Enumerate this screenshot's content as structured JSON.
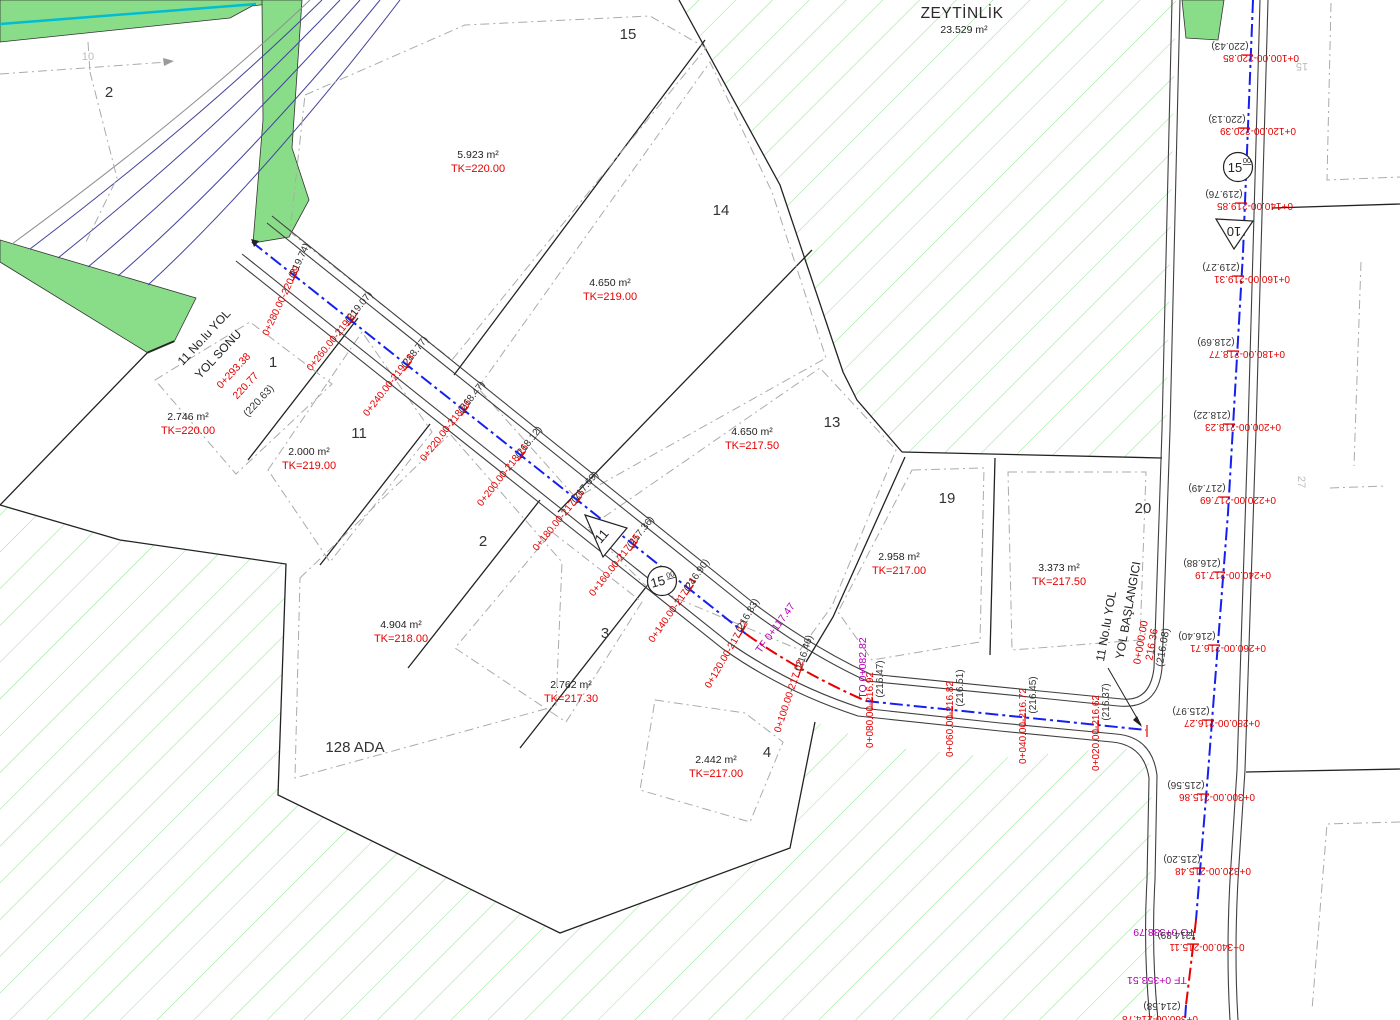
{
  "zeytinlik": {
    "name": "ZEYTİNLİK",
    "area": "23.529 m²"
  },
  "block_label": "128 ADA",
  "road_end": {
    "line1": "11 No.lu YOL",
    "line2": "YOL SONU",
    "km": "0+293.38",
    "elev": "220.77",
    "ground": "(220.63)"
  },
  "road_start": {
    "line1": "11 No.lu YOL",
    "line2": "YOL BAŞLANGICI",
    "km": "0+000.00",
    "elev": "216.36",
    "ground": "(216.08)"
  },
  "symbols": {
    "road11_sign": "11",
    "road10_sign": "10",
    "width11": "15",
    "width11_sup": "00",
    "width10": "15",
    "width10_sup": "00"
  },
  "faint_labels": {
    "p10": "10",
    "p15": "15",
    "p27": "27"
  },
  "curve_points": {
    "tf1": "TF 0+117.47",
    "to1": "TO 0+082.82",
    "to2": "TO 0+338.79",
    "tf2": "TF 0+353.51",
    "cut": "0+360.00-214.78",
    "cut_ground": "(214.58)"
  },
  "parcels": [
    {
      "no": "2",
      "area": "",
      "tk": "",
      "npos": [
        109,
        97
      ],
      "apos": null
    },
    {
      "no": "15",
      "area": "5.923 m²",
      "tk": "TK=220.00",
      "npos": [
        628,
        39
      ],
      "apos": [
        478,
        158
      ]
    },
    {
      "no": "14",
      "area": "4.650 m²",
      "tk": "TK=219.00",
      "npos": [
        721,
        215
      ],
      "apos": [
        610,
        286
      ]
    },
    {
      "no": "13",
      "area": "4.650 m²",
      "tk": "TK=217.50",
      "npos": [
        832,
        427
      ],
      "apos": [
        752,
        435
      ]
    },
    {
      "no": "19",
      "area": "2.958 m²",
      "tk": "TK=217.00",
      "npos": [
        947,
        503
      ],
      "apos": [
        899,
        560
      ]
    },
    {
      "no": "20",
      "area": "3.373 m²",
      "tk": "TK=217.50",
      "npos": [
        1143,
        513
      ],
      "apos": [
        1059,
        571
      ]
    },
    {
      "no": "1",
      "area": "2.746 m²",
      "tk": "TK=220.00",
      "npos": [
        273,
        367
      ],
      "apos": [
        188,
        420
      ]
    },
    {
      "no": "11",
      "area": "2.000 m²",
      "tk": "TK=219.00",
      "npos": [
        359,
        438
      ],
      "apos": [
        309,
        455
      ]
    },
    {
      "no": "2",
      "area": "4.904 m²",
      "tk": "TK=218.00",
      "npos": [
        483,
        546
      ],
      "apos": [
        401,
        628
      ]
    },
    {
      "no": "3",
      "area": "2.762 m²",
      "tk": "TK=217.30",
      "npos": [
        605,
        638
      ],
      "apos": [
        571,
        688
      ]
    },
    {
      "no": "4",
      "area": "2.442 m²",
      "tk": "TK=217.00",
      "npos": [
        767,
        757
      ],
      "apos": [
        716,
        763
      ]
    }
  ],
  "roads": {
    "road11": {
      "stations": [
        {
          "label": "0+280.00-220.39",
          "ground": "(219.74)",
          "rot": -65,
          "red": [
            284,
            302
          ],
          "gnd": [
            302,
            262
          ],
          "tick": [
            295,
            276
          ]
        },
        {
          "label": "0+260.00-219.81",
          "ground": "(219.07)",
          "rot": -51,
          "red": [
            335,
            342
          ],
          "gnd": [
            361,
            309
          ],
          "tick": [
            352,
            321
          ]
        },
        {
          "label": "0+240.00-219.28",
          "ground": "(218.77)",
          "rot": -52,
          "red": [
            391,
            387
          ],
          "gnd": [
            417,
            354
          ],
          "tick": [
            408,
            366
          ]
        },
        {
          "label": "0+220.00-218.66",
          "ground": "(218.47)",
          "rot": -52,
          "red": [
            448,
            432
          ],
          "gnd": [
            474,
            399
          ],
          "tick": [
            465,
            411
          ]
        },
        {
          "label": "0+200.00-218.16",
          "ground": "(218.12)",
          "rot": -52,
          "red": [
            505,
            477
          ],
          "gnd": [
            531,
            444
          ],
          "tick": [
            522,
            456
          ]
        },
        {
          "label": "0+180.00-217.76",
          "ground": "(217.69)",
          "rot": -51,
          "red": [
            561,
            522
          ],
          "gnd": [
            587,
            489
          ],
          "tick": [
            578,
            501
          ]
        },
        {
          "label": "0+160.00-217.45",
          "ground": "(217.36)",
          "rot": -52,
          "red": [
            617,
            567
          ],
          "gnd": [
            643,
            534
          ],
          "tick": [
            634,
            546
          ]
        },
        {
          "label": "0+140.00-217.24",
          "ground": "(216.90)",
          "rot": -55,
          "red": [
            675,
            612
          ],
          "gnd": [
            699,
            577
          ],
          "tick": [
            690,
            590
          ]
        },
        {
          "label": "0+120.00-217.12",
          "ground": "(216.83)",
          "rot": -60,
          "red": [
            729,
            656
          ],
          "gnd": [
            750,
            617
          ],
          "tick": [
            742,
            632
          ]
        },
        {
          "label": "0+100.00-217.02",
          "ground": "(216.46)",
          "rot": -72,
          "red": [
            792,
            697
          ],
          "gnd": [
            807,
            654
          ],
          "tick": [
            800,
            672
          ]
        },
        {
          "label": "0+080.00-216.92",
          "ground": "(216.47)",
          "rot": -90,
          "red": [
            873,
            710
          ],
          "gnd": [
            883,
            679
          ],
          "tick": [
            872,
            703
          ]
        },
        {
          "label": "0+060.00-216.82",
          "ground": "(216.51)",
          "rot": -90,
          "red": [
            953,
            719
          ],
          "gnd": [
            963,
            688
          ],
          "tick": [
            952,
            712
          ]
        },
        {
          "label": "0+040.00-216.72",
          "ground": "(216.45)",
          "rot": -90,
          "red": [
            1026,
            726
          ],
          "gnd": [
            1036,
            695
          ],
          "tick": [
            1025,
            719
          ]
        },
        {
          "label": "0+020.00-216.62",
          "ground": "(216.37)",
          "rot": -90,
          "red": [
            1099,
            733
          ],
          "gnd": [
            1109,
            702
          ],
          "tick": [
            1098,
            726
          ]
        }
      ]
    },
    "road10": {
      "stations": [
        {
          "label": "0+100.00-220.85",
          "ground": "(220.43)",
          "red": [
            1261,
            55
          ],
          "gnd": [
            1230,
            43
          ],
          "tick": [
            1247,
            55
          ]
        },
        {
          "label": "0+120.00-220.39",
          "ground": "(220.13)",
          "red": [
            1258,
            128
          ],
          "gnd": [
            1227,
            116
          ],
          "tick": [
            1244,
            128
          ]
        },
        {
          "label": "0+140.00-219.85",
          "ground": "(219.76)",
          "red": [
            1255,
            203
          ],
          "gnd": [
            1224,
            191
          ],
          "tick": [
            1241,
            203
          ]
        },
        {
          "label": "0+160.00-219.31",
          "ground": "(219.27)",
          "red": [
            1252,
            276
          ],
          "gnd": [
            1221,
            264
          ],
          "tick": [
            1238,
            276
          ]
        },
        {
          "label": "0+180.00-218.77",
          "ground": "(218.69)",
          "red": [
            1247,
            351
          ],
          "gnd": [
            1216,
            339
          ],
          "tick": [
            1233,
            351
          ]
        },
        {
          "label": "0+200.00-218.23",
          "ground": "(218.22)",
          "red": [
            1243,
            424
          ],
          "gnd": [
            1212,
            412
          ],
          "tick": [
            1229,
            424
          ]
        },
        {
          "label": "0+220.00-217.69",
          "ground": "(217.49)",
          "red": [
            1238,
            497
          ],
          "gnd": [
            1207,
            485
          ],
          "tick": [
            1224,
            497
          ]
        },
        {
          "label": "0+240.00-217.19",
          "ground": "(216.88)",
          "red": [
            1233,
            572
          ],
          "gnd": [
            1202,
            560
          ],
          "tick": [
            1219,
            572
          ]
        },
        {
          "label": "0+260.00-216.71",
          "ground": "(216.40)",
          "red": [
            1228,
            645
          ],
          "gnd": [
            1197,
            633
          ],
          "tick": [
            1214,
            645
          ]
        },
        {
          "label": "0+280.00-216.27",
          "ground": "(215.97)",
          "red": [
            1222,
            720
          ],
          "gnd": [
            1191,
            708
          ],
          "tick": [
            1208,
            720
          ]
        },
        {
          "label": "0+300.00-215.86",
          "ground": "(215.56)",
          "red": [
            1217,
            794
          ],
          "gnd": [
            1186,
            782
          ],
          "tick": [
            1203,
            794
          ]
        },
        {
          "label": "0+320.00-215.48",
          "ground": "(215.20)",
          "red": [
            1213,
            868
          ],
          "gnd": [
            1182,
            856
          ],
          "tick": [
            1199,
            868
          ]
        },
        {
          "label": "0+340.00-215.11",
          "ground": "(214.89)",
          "red": [
            1207,
            944
          ],
          "gnd": [
            1176,
            932
          ],
          "tick": [
            1193,
            944
          ]
        }
      ]
    }
  },
  "colors": {
    "hatch_line": "#8fe28f",
    "solid_green": "#89dd89",
    "cyan": "#00bcd4",
    "red": "#e60000",
    "blue": "#1520ee",
    "purple": "#b800b8"
  }
}
